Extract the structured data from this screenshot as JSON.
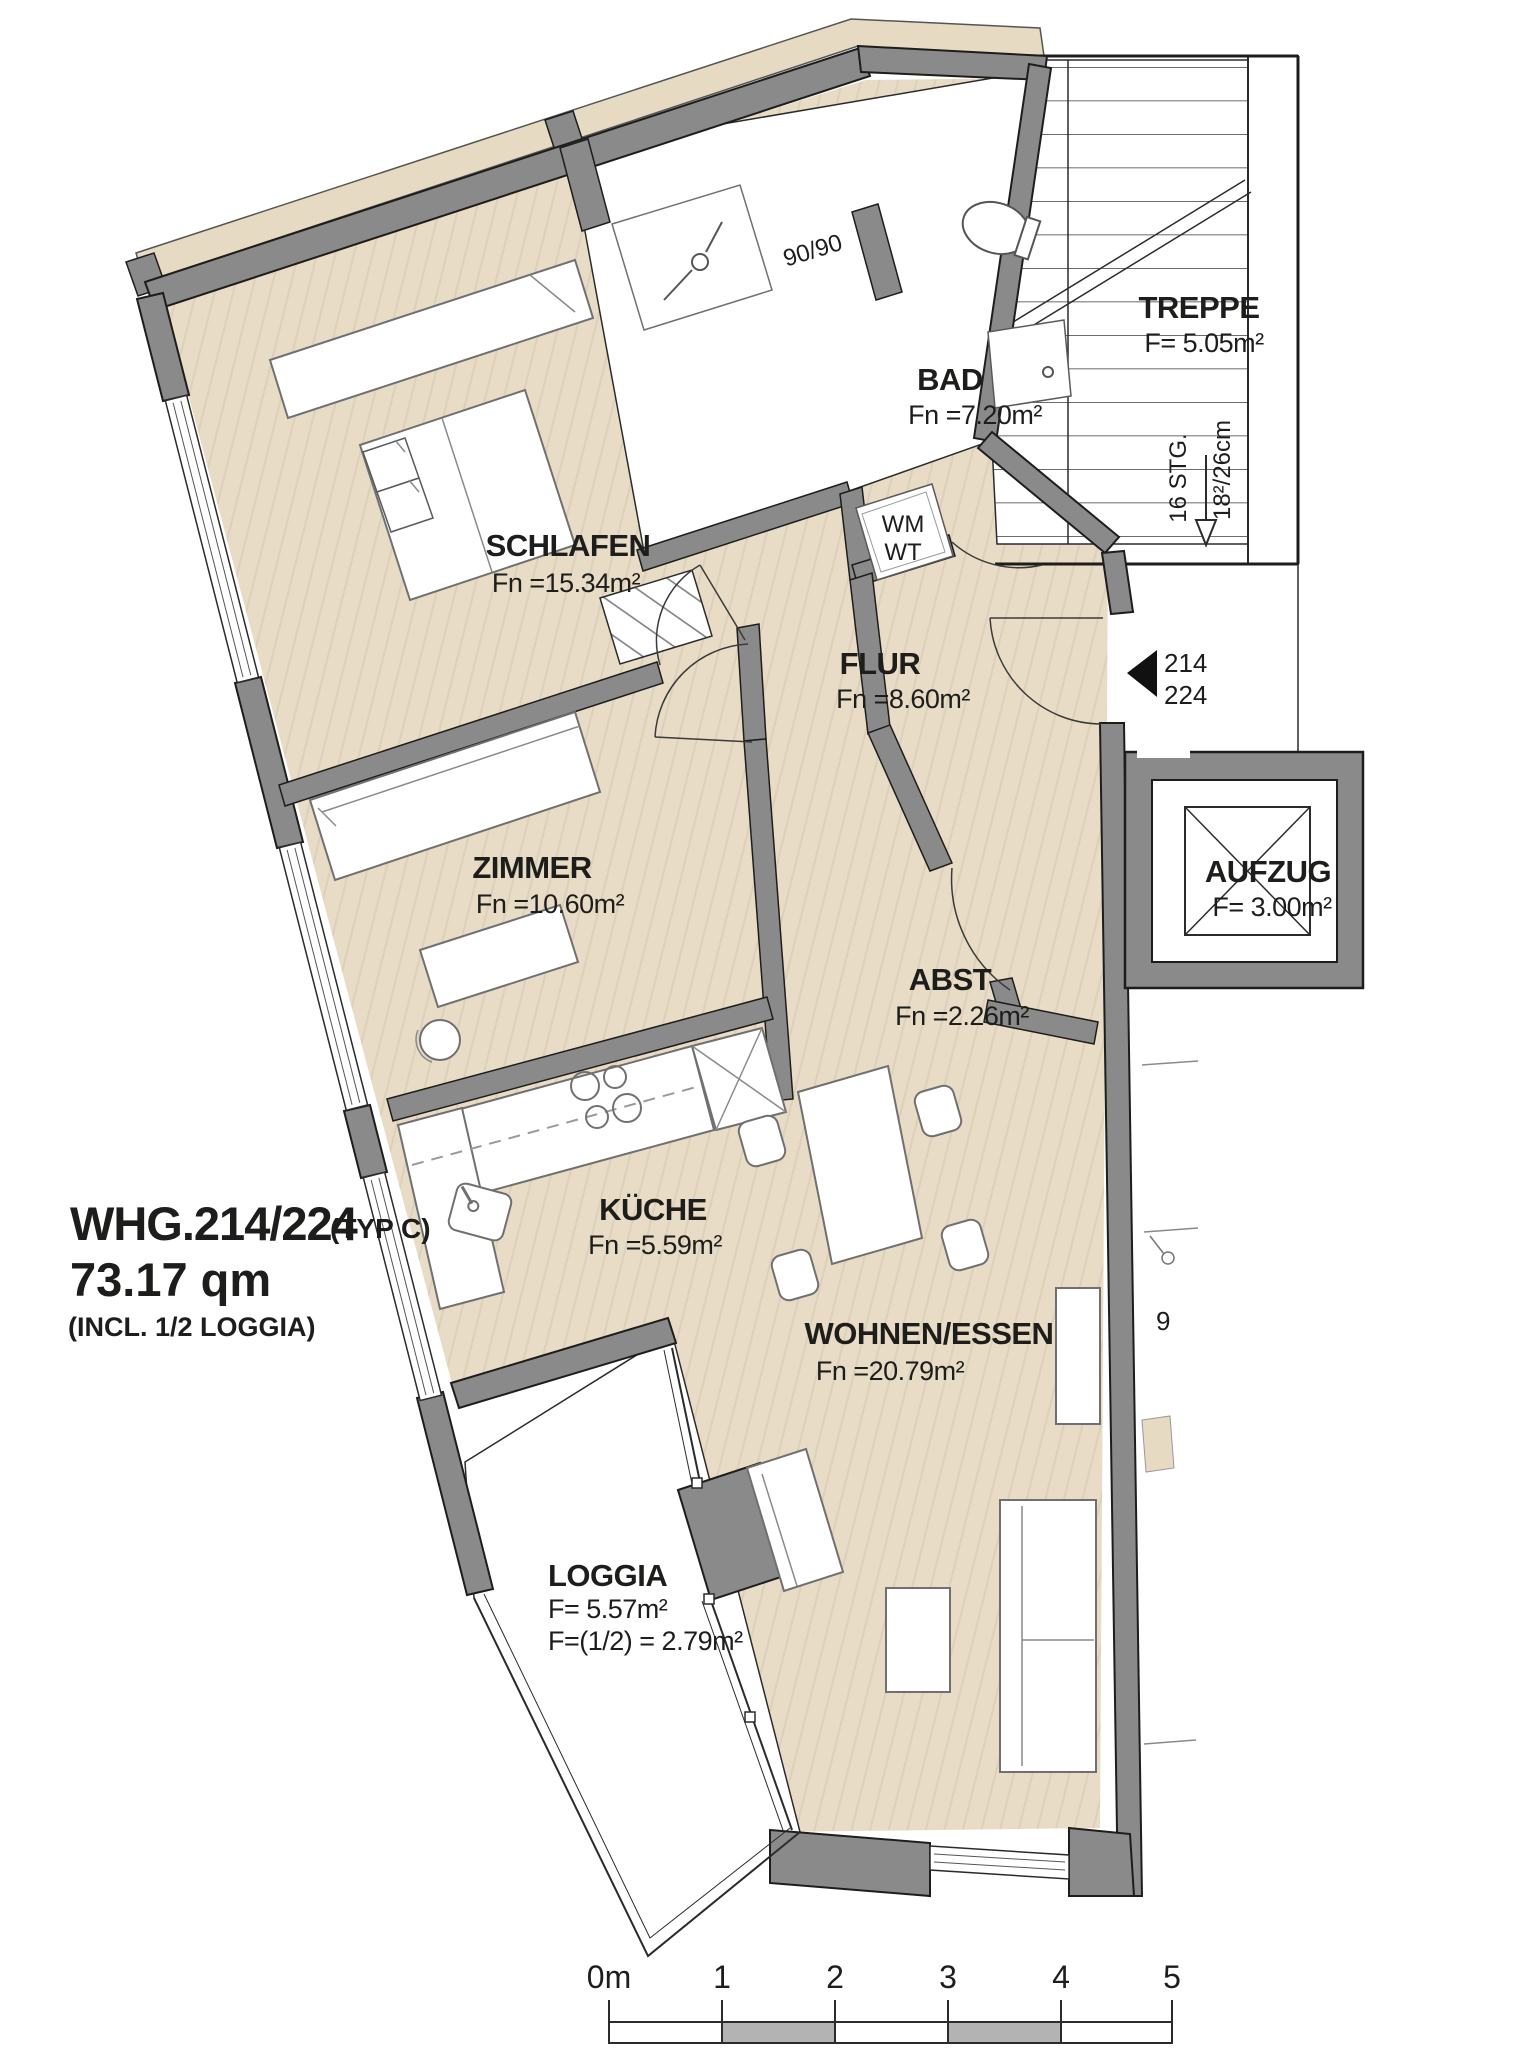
{
  "document": {
    "kind": "apartment floor plan"
  },
  "title": {
    "line1": "WHG.214/224",
    "variant": "(TYP C)",
    "line2": "73.17 qm",
    "line3": "(INCL. 1/2 LOGGIA)"
  },
  "rooms": [
    {
      "id": "schlafen",
      "name": "SCHLAFEN",
      "area": "Fn =15.34m²"
    },
    {
      "id": "bad",
      "name": "BAD",
      "area": "Fn =7.20m²"
    },
    {
      "id": "flur",
      "name": "FLUR",
      "area": "Fn =8.60m²"
    },
    {
      "id": "zimmer",
      "name": "ZIMMER",
      "area": "Fn =10.60m²"
    },
    {
      "id": "abst",
      "name": "ABST",
      "area": "Fn =2.26m²"
    },
    {
      "id": "kueche",
      "name": "KÜCHE",
      "area": "Fn =5.59m²"
    },
    {
      "id": "wohnen",
      "name": "WOHNEN/ESSEN",
      "area": "Fn =20.79m²"
    },
    {
      "id": "loggia",
      "name": "LOGGIA",
      "area": "F= 5.57m²",
      "area_half": "F=(1/2) = 2.79m²"
    },
    {
      "id": "treppe",
      "name": "TREPPE",
      "area": "F= 5.05m²"
    },
    {
      "id": "aufzug",
      "name": "AUFZUG",
      "area": "F= 3.00m²"
    }
  ],
  "labels": {
    "shower_size": "90/90",
    "washing_machine": "WM",
    "washing_tumbler": "WT",
    "stair_steps": "16 STG.",
    "stair_riser": "18²/26cm",
    "neighbor_fragment": "9"
  },
  "entrance": {
    "marker_numbers": [
      "214",
      "224"
    ]
  },
  "scale_bar": {
    "unit_labels": [
      "0m",
      "1",
      "2",
      "3",
      "4",
      "5"
    ]
  },
  "colors": {
    "wall_gray": "#8a8a8a",
    "floor_wood": "#e8dcc6",
    "floor_grain": "#dccfb8",
    "exterior_band": "#e6dac3",
    "outline": "#1d1d1b",
    "scale_segment_gray": "#b3b3b3",
    "background": "#ffffff"
  }
}
